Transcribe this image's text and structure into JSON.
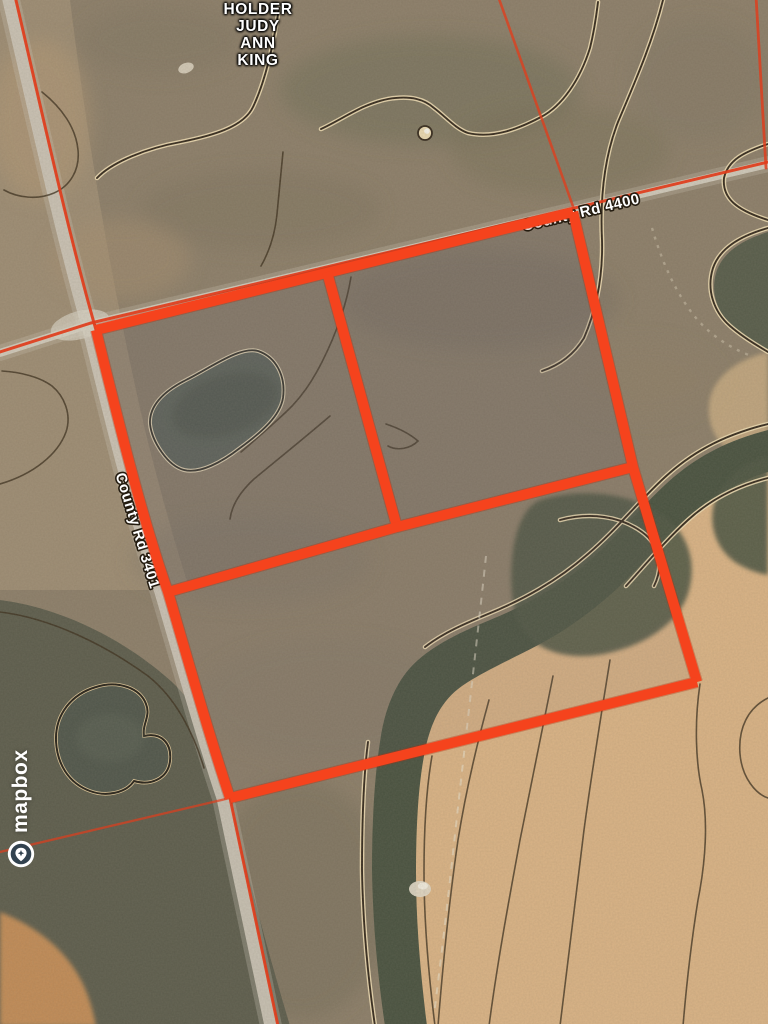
{
  "map": {
    "owner_lines": [
      "HOLDER",
      "JUDY",
      "ANN",
      "KING"
    ],
    "road_labels": {
      "northeast": "County Rd 4400",
      "west": "County Rd 3401"
    },
    "attribution": {
      "brand": "mapbox"
    },
    "colors": {
      "boundary_highlight": "#f5431d",
      "parcel_line": "#e03d1c",
      "road_surface": "#cfc8ba",
      "scrub": "#8b7d68",
      "field_tan": "#d9b284",
      "creek_dark": "#47503e",
      "contour_line": "#32271a",
      "contour_halo": "#eedcb2",
      "label_text": "#ffffff"
    }
  }
}
